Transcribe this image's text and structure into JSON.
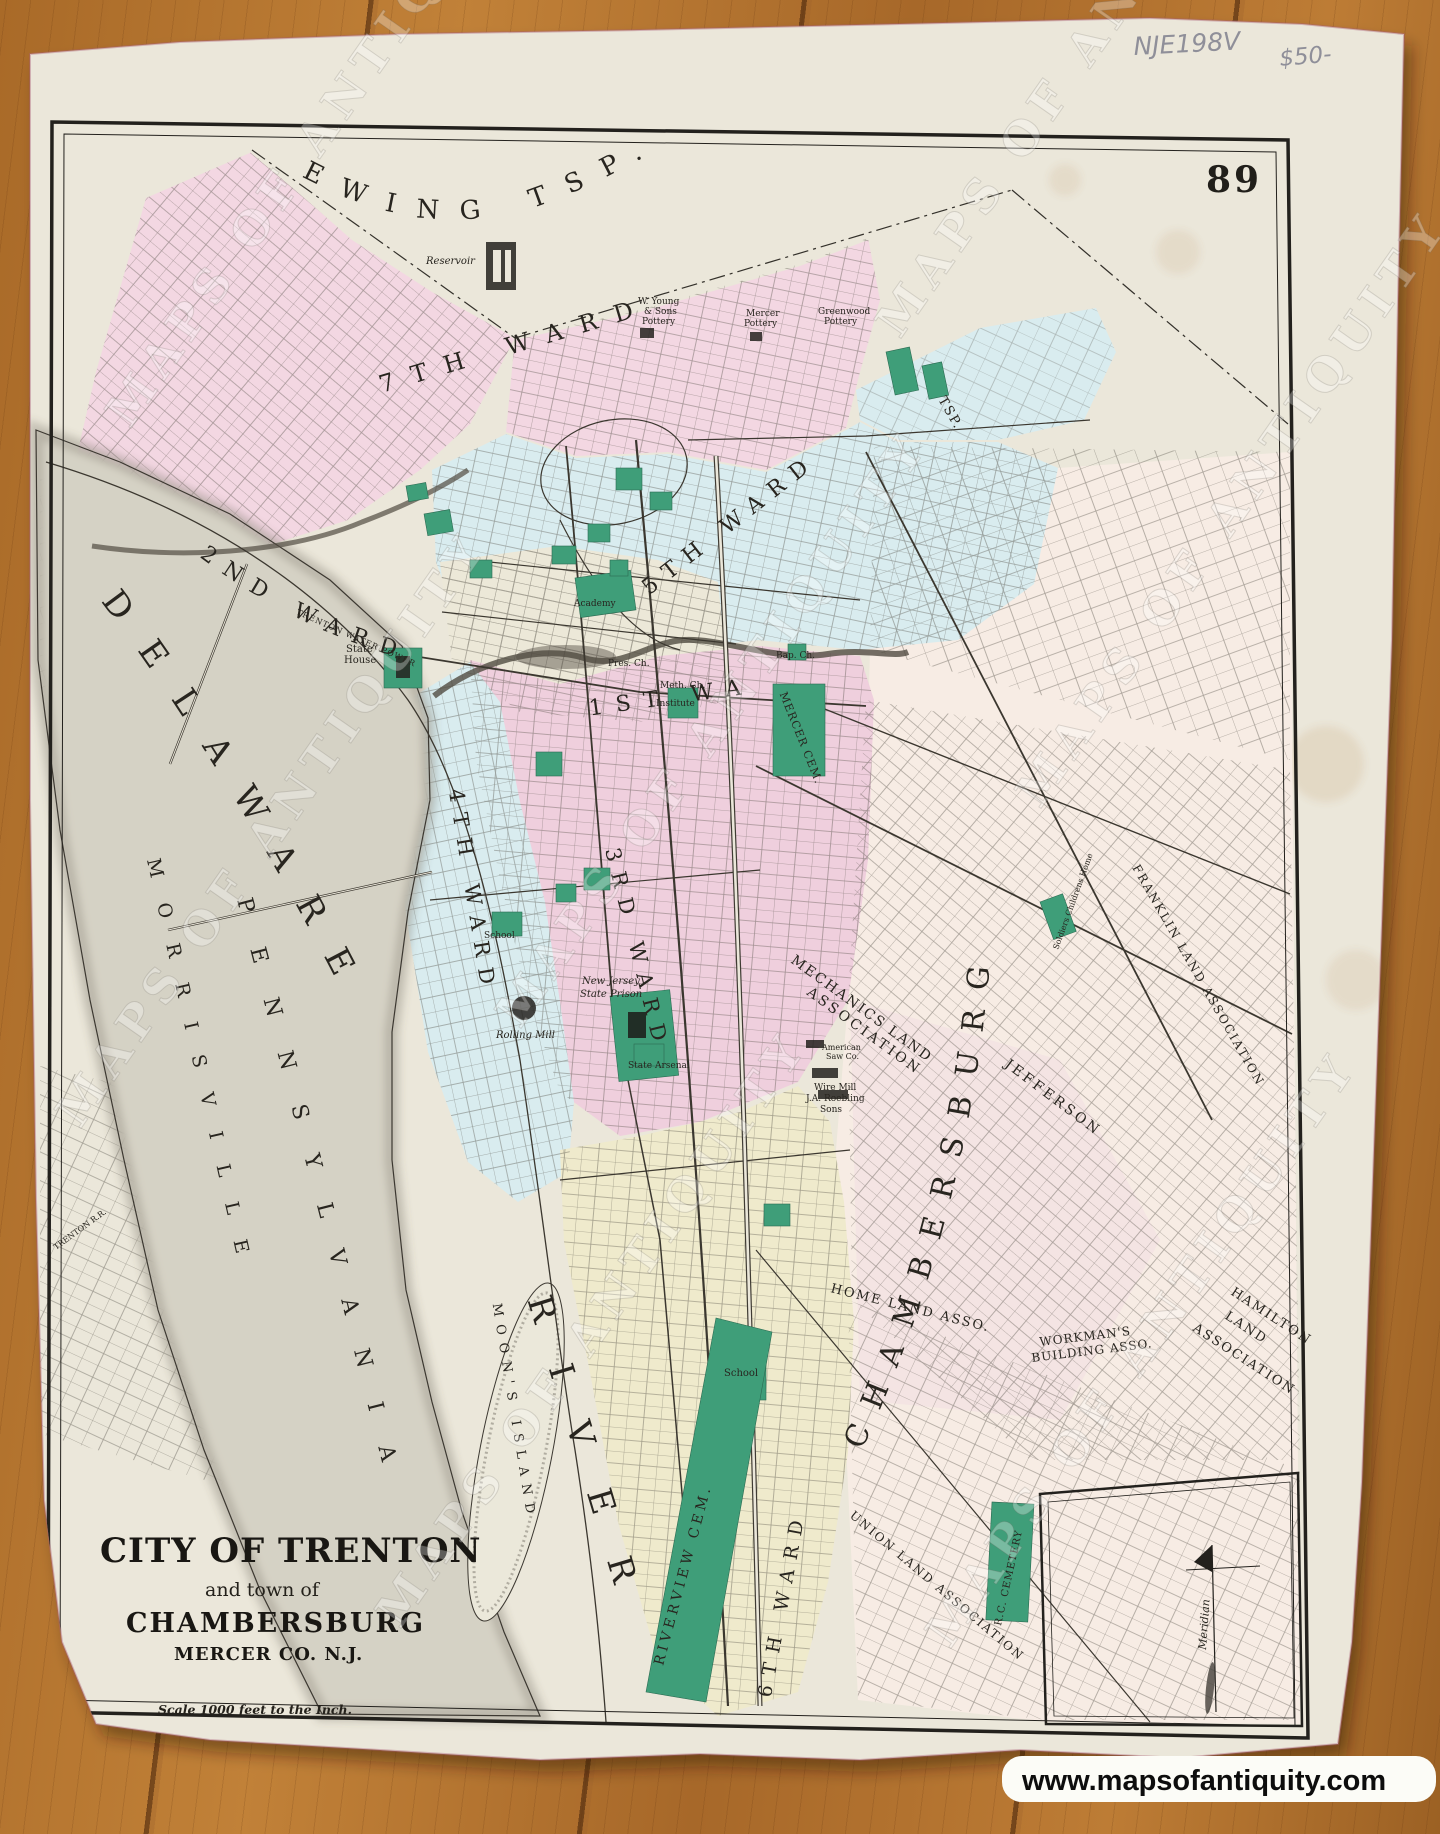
{
  "photo": {
    "page_number": "89",
    "pencil_notes": [
      "NJE198V",
      "$50-"
    ],
    "watermark_text": "MAPS OF ANTIQUITY",
    "website": "www.mapsofantiquity.com",
    "watermark_positions": [
      {
        "x": 130,
        "y": 430
      },
      {
        "x": 900,
        "y": 340
      },
      {
        "x": 80,
        "y": 1130
      },
      {
        "x": 520,
        "y": 1030
      },
      {
        "x": 1040,
        "y": 810
      },
      {
        "x": 400,
        "y": 1630
      },
      {
        "x": 950,
        "y": 1650
      }
    ]
  },
  "title_block": {
    "line1": "CITY OF TRENTON",
    "line2": "and town of",
    "line3": "CHAMBERSBURG",
    "line4": "MERCER CO. N.J.",
    "scale": "Scale 1000 feet to the Inch."
  },
  "colors": {
    "ward_pink": "#f3d7e2",
    "ward_rose": "#efcfdd",
    "ward_blue": "#d9ecef",
    "ward_yellow": "#efeacc",
    "east_cream": "#f7ece4",
    "public_green": "#3f9e79",
    "paper": "#ebe7da"
  },
  "map_labels": {
    "curved": [
      {
        "t": "EWING TSP.",
        "path": "p-ewing",
        "size": 26,
        "sp": 22
      },
      {
        "t": "DELAWARE",
        "path": "p-del",
        "size": 34,
        "sp": 34
      },
      {
        "t": "RIVER",
        "path": "p-riv",
        "size": 34,
        "sp": 46
      },
      {
        "t": "PENNSYLVANIA",
        "path": "p-penn",
        "size": 22,
        "sp": 36
      },
      {
        "t": "MORRISVILLE",
        "path": "p-mor",
        "size": 19,
        "sp": 26
      },
      {
        "t": "CHAMBERSBURG",
        "path": "p-cham",
        "size": 30,
        "sp": 20
      },
      {
        "t": "MOON'S ISLAND",
        "path": "p-moon",
        "size": 13,
        "sp": 8
      },
      {
        "t": "2ND WARD",
        "path": "p-w2",
        "size": 22,
        "sp": 13
      },
      {
        "t": "5TH WARD",
        "path": "p-w5",
        "size": 22,
        "sp": 11
      },
      {
        "t": "4TH WARD",
        "path": "p-w4",
        "size": 21,
        "sp": 11
      },
      {
        "t": "3RD WARD",
        "path": "p-w3",
        "size": 21,
        "sp": 11
      },
      {
        "t": "6TH WARD",
        "path": "p-w6",
        "size": 19,
        "sp": 10
      },
      {
        "t": "1ST WARD",
        "path": "p-w1",
        "size": 22,
        "sp": 13
      },
      {
        "t": "7TH WARD",
        "path": "p-w7",
        "size": 24,
        "sp": 18
      },
      {
        "t": "RIVERVIEW CEM.",
        "path": "p-rv",
        "size": 14,
        "sp": 4
      },
      {
        "t": "MERCER CEM.",
        "path": "p-mc",
        "size": 11,
        "sp": 1
      },
      {
        "t": "FRANKLIN LAND ASSOCIATION",
        "path": "p-fr",
        "size": 12,
        "sp": 2
      },
      {
        "t": "UNION LAND ASSOCIATION",
        "path": "p-un",
        "size": 12,
        "sp": 2
      },
      {
        "t": "R.C. CEMETERY",
        "path": "p-rc",
        "size": 10,
        "sp": 1
      },
      {
        "t": "TSP.",
        "path": "p-tsp",
        "size": 13,
        "sp": 2
      }
    ],
    "flat": [
      {
        "t": "HOME LAND ASSO.",
        "x": 830,
        "y": 1292,
        "r": 14,
        "size": 13,
        "sp": 2
      },
      {
        "t": "MECHANICS LAND",
        "x": 790,
        "y": 962,
        "r": 36,
        "size": 14,
        "sp": 2
      },
      {
        "t": "ASSOCIATION",
        "x": 806,
        "y": 994,
        "r": 36,
        "size": 14,
        "sp": 3
      },
      {
        "t": "HAMILTON",
        "x": 1230,
        "y": 1294,
        "r": 33,
        "size": 13,
        "sp": 2
      },
      {
        "t": "LAND",
        "x": 1224,
        "y": 1318,
        "r": 33,
        "size": 13,
        "sp": 2
      },
      {
        "t": "ASSOCIATION",
        "x": 1192,
        "y": 1330,
        "r": 33,
        "size": 13,
        "sp": 2
      },
      {
        "t": "JEFFERSON",
        "x": 1004,
        "y": 1066,
        "r": 37,
        "size": 14,
        "sp": 3
      },
      {
        "t": "WORKMAN'S",
        "x": 1040,
        "y": 1346,
        "r": -7,
        "size": 12,
        "sp": 1
      },
      {
        "t": "BUILDING ASSO.",
        "x": 1032,
        "y": 1362,
        "r": -7,
        "size": 12,
        "sp": 1
      },
      {
        "t": "Soldiers Childrens Home",
        "x": 1058,
        "y": 950,
        "r": -70,
        "size": 8
      },
      {
        "t": "Meridian",
        "x": 1206,
        "y": 1650,
        "r": -86,
        "size": 11,
        "cls": "it"
      },
      {
        "t": "TRENTON WATER POWER",
        "x": 296,
        "y": 614,
        "r": 24,
        "size": 8,
        "sp": 1
      },
      {
        "t": "TRENTON R.R.",
        "x": 56,
        "y": 1250,
        "r": -36,
        "size": 8
      },
      {
        "t": "Reservoir",
        "x": 426,
        "y": 264,
        "size": 10,
        "cls": "it"
      },
      {
        "t": "W. Young",
        "x": 638,
        "y": 304,
        "size": 9
      },
      {
        "t": "& Sons",
        "x": 644,
        "y": 314,
        "size": 9
      },
      {
        "t": "Pottery",
        "x": 642,
        "y": 324,
        "size": 9
      },
      {
        "t": "Mercer",
        "x": 746,
        "y": 316,
        "size": 9
      },
      {
        "t": "Pottery",
        "x": 744,
        "y": 326,
        "size": 9
      },
      {
        "t": "Greenwood",
        "x": 818,
        "y": 314,
        "size": 9
      },
      {
        "t": "Pottery",
        "x": 824,
        "y": 324,
        "size": 9
      },
      {
        "t": "State",
        "x": 346,
        "y": 652,
        "size": 10
      },
      {
        "t": "House",
        "x": 344,
        "y": 663,
        "size": 10
      },
      {
        "t": "Academy",
        "x": 574,
        "y": 606,
        "size": 9
      },
      {
        "t": "Pres. Ch.",
        "x": 608,
        "y": 666,
        "size": 9
      },
      {
        "t": "Bap. Ch.",
        "x": 776,
        "y": 658,
        "size": 9
      },
      {
        "t": "Meth. Ch.",
        "x": 660,
        "y": 688,
        "size": 9
      },
      {
        "t": "Institute",
        "x": 656,
        "y": 706,
        "size": 9
      },
      {
        "t": "New Jersey",
        "x": 582,
        "y": 984,
        "size": 10,
        "cls": "it"
      },
      {
        "t": "State Prison",
        "x": 580,
        "y": 997,
        "size": 10,
        "cls": "it"
      },
      {
        "t": "State Arsenal",
        "x": 628,
        "y": 1068,
        "size": 9
      },
      {
        "t": "Rolling Mill",
        "x": 496,
        "y": 1038,
        "size": 10,
        "cls": "it"
      },
      {
        "t": "School",
        "x": 484,
        "y": 938,
        "size": 9
      },
      {
        "t": "School",
        "x": 724,
        "y": 1376,
        "size": 10
      },
      {
        "t": "American",
        "x": 822,
        "y": 1050,
        "size": 8
      },
      {
        "t": "Saw Co.",
        "x": 826,
        "y": 1059,
        "size": 8
      },
      {
        "t": "Wire Mill",
        "x": 814,
        "y": 1090,
        "size": 9
      },
      {
        "t": "J.A. Roebling",
        "x": 806,
        "y": 1101,
        "size": 9
      },
      {
        "t": "Sons",
        "x": 820,
        "y": 1112,
        "size": 9
      }
    ]
  }
}
